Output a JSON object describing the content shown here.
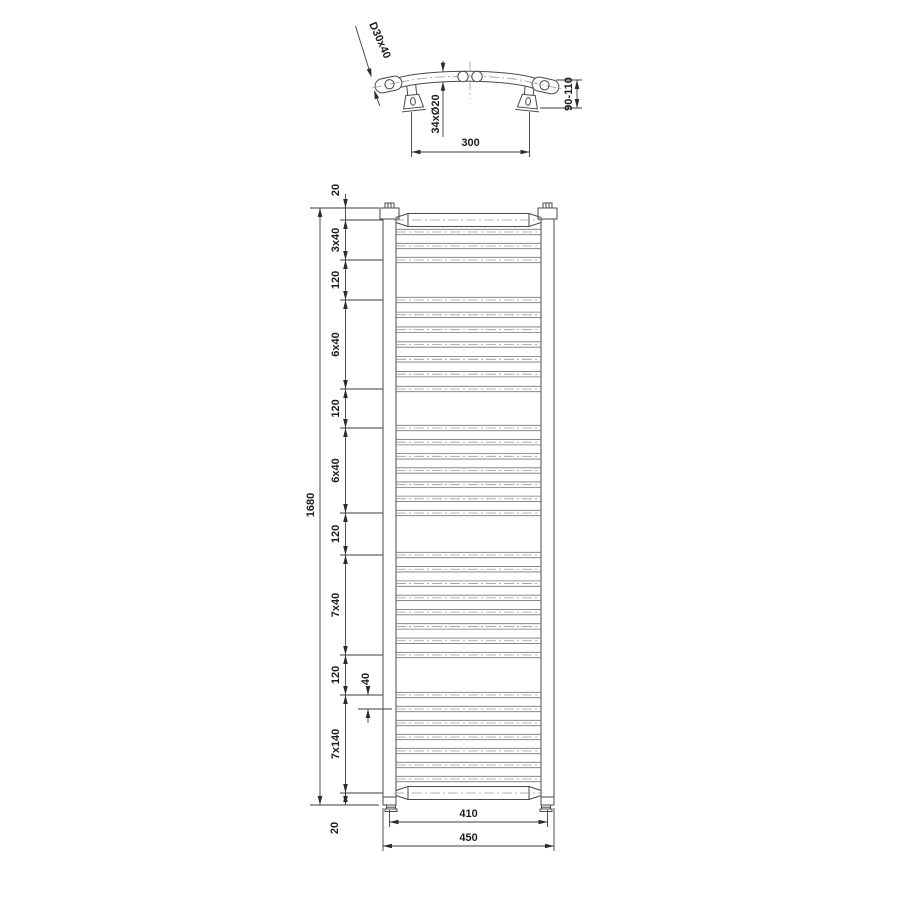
{
  "page": {
    "background": "#ffffff"
  },
  "drawing_type": "heated towel rail radiator technical dimension drawing (top view and front view)",
  "top_view": {
    "profile_label": "D30x40",
    "tube_count_label": "34xØ20",
    "wall_distance_label": "90-110",
    "bracket_spacing_label": "300"
  },
  "front_view": {
    "overall_height_label": "1680",
    "segment_labels": [
      "20",
      "3x40",
      "120",
      "6x40",
      "120",
      "6x40",
      "120",
      "7x40",
      "120",
      "7x140",
      "20"
    ],
    "tube_gap_label": "40",
    "connection_width_label": "410",
    "overall_width_label": "450",
    "tube_groups_top_to_bottom": [
      3,
      7,
      7,
      8,
      7
    ],
    "total_rungs_including_rails": 34
  },
  "colors": {
    "outline": "#4a4a4a",
    "rung": "#757575",
    "centerline": "#9c9c9c",
    "dimension": "#3d3d3d",
    "text": "#1c1c1c"
  }
}
